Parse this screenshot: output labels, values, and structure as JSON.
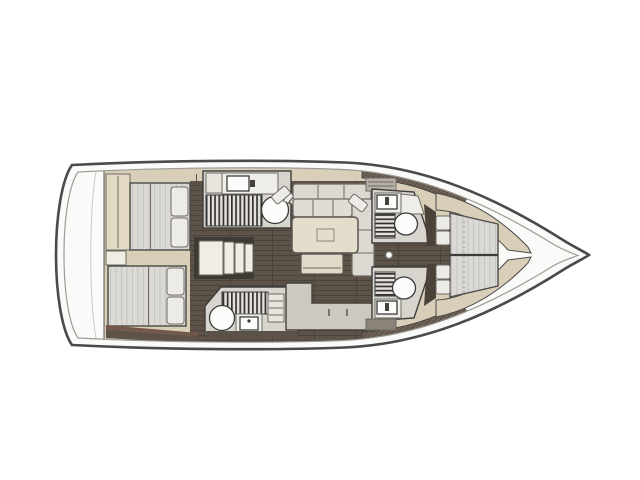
{
  "figure": {
    "kind": "sailing yacht interior layout plan, top-down view",
    "orientation": "bow pointing right, stern at left",
    "visible_text": ""
  },
  "colors": {
    "hull-line": "#4a4a4a",
    "inner-line": "#9b9b97",
    "deck-white": "#fafaf8",
    "cabinetry": "#d9ceb7",
    "wardrobe": "#e3dac5",
    "floor-brown": "#5d5349",
    "floor-line": "#4b4239",
    "room-gray": "#d8d5ce",
    "fixture-white": "#fcfcfb",
    "counter-cream": "#efede9",
    "grate-bg": "#e3e1dc",
    "grate-bar": "#35322e",
    "mattress": "#dbd9d5",
    "mattress-stripe": "#c7c5c1",
    "pillow": "#edebe7",
    "cushion": "#dcd9d2",
    "cushion-light": "#e0ddd6",
    "table": "#e4ddcb",
    "bench": "#e0d9c7",
    "steps": "#f0ede5",
    "galley-counter": "#cdc9c0",
    "hatch-brown": "#6e6156",
    "hatch-line": "#594e44",
    "dark-wood": "#4b4239",
    "locker-gray": "#b7b2a9",
    "outline": "#3c3c3c",
    "outline-soft": "#6e6a63",
    "page-bg": "#ffffff"
  },
  "areas": {
    "aft_deck": {
      "features": [
        "open white transom area",
        "transom step"
      ]
    },
    "aft_cabin_upper": {
      "features": [
        "double berth with striped mattress",
        "2 pillows",
        "wardrobe panel"
      ]
    },
    "aft_cabin_lower": {
      "features": [
        "double berth with striped mattress",
        "2 pillows"
      ]
    },
    "aft_head_upper": {
      "features": [
        "washbasin counter",
        "vertical shower grating",
        "toilet",
        "open door panel"
      ]
    },
    "aft_head_lower": {
      "features": [
        "toilet",
        "vertical shower grating",
        "washbasin",
        "shelf unit"
      ]
    },
    "companionway": {
      "steps": 4
    },
    "saloon": {
      "features": [
        "U-shaped settee",
        "2 angled throw cushions",
        "rectangular table",
        "bench seat"
      ]
    },
    "galley": {
      "features": [
        "L-shaped counter",
        "2 drawer handles"
      ]
    },
    "fwd_head_upper": {
      "features": [
        "washbasin",
        "horizontal shower grating",
        "toilet",
        "locker unit"
      ]
    },
    "fwd_head_lower": {
      "features": [
        "horizontal shower grating",
        "toilet",
        "washbasin",
        "locker band"
      ]
    },
    "corridor": {
      "features": [
        "door knob dot"
      ]
    },
    "forward_cabin": {
      "features": [
        "tapering double berth",
        "4 pillows",
        "centre seam",
        "beige side shelves"
      ]
    },
    "bow_peak": {
      "features": [
        "unfurnished tapering area"
      ]
    }
  }
}
